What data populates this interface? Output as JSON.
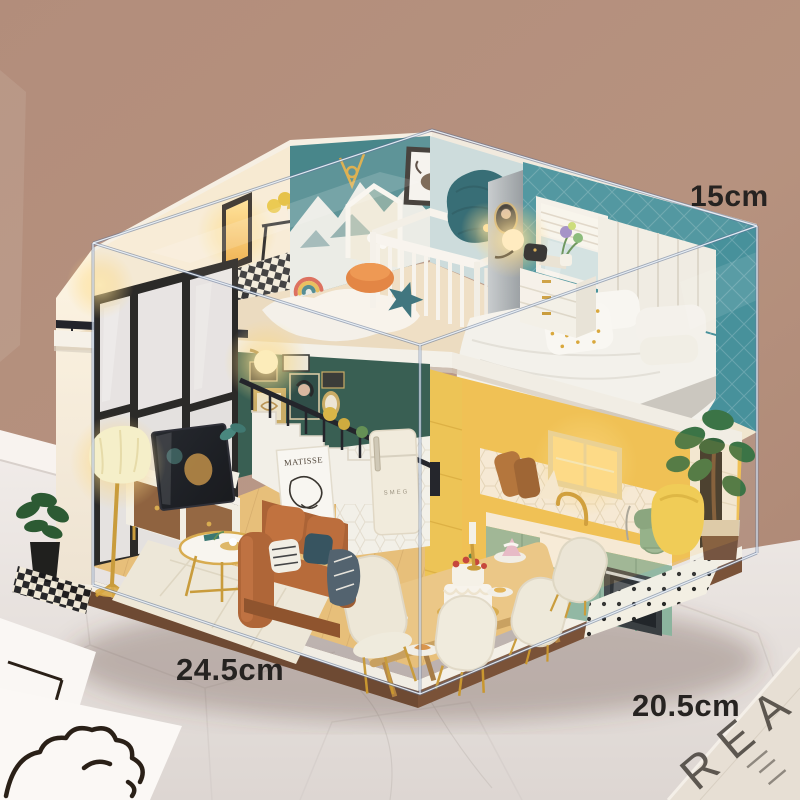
{
  "annotations": {
    "height_label": "15cm",
    "width_label": "24.5cm",
    "depth_label": "20.5cm"
  },
  "decor": {
    "poster_title": "MATISSE",
    "fridge_brand": "SMEG",
    "paper_letters": "REA"
  },
  "colors": {
    "background_wall": "#b5917f",
    "marble_floor": "#efe9e6",
    "acrylic_edge": "#5f7296",
    "nursery_wall_teal": "#48868a",
    "bedroom_wall_teal": "#3c8a94",
    "gallery_wall_green": "#2e5648",
    "kitchen_wall_yellow": "#f0c14c",
    "cabinet_sage": "#8cb49e",
    "sofa_leather": "#b5622d",
    "wood_base": "#6e4a33",
    "accent_gold": "#c9972f",
    "glow_warm": "#ffdf9a"
  }
}
